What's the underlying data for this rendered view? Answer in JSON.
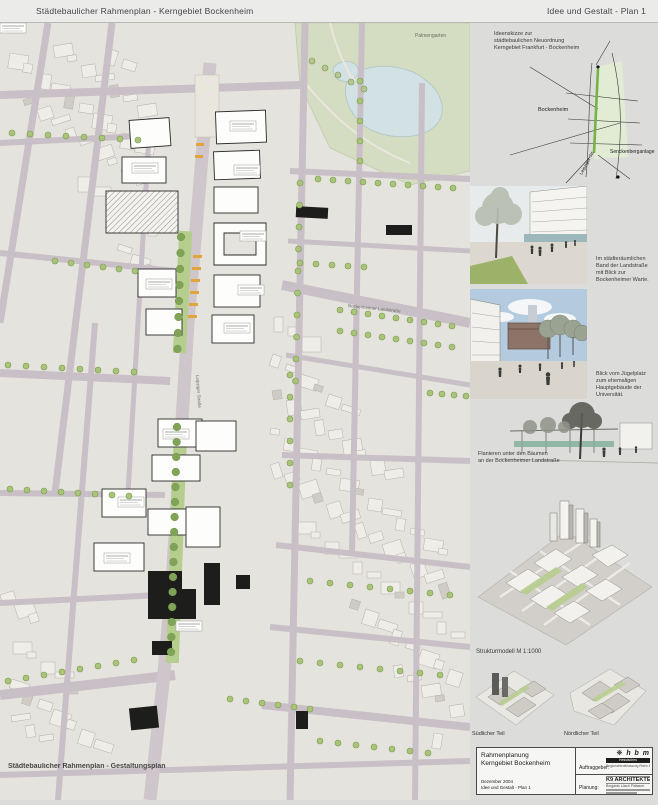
{
  "header": {
    "title_left": "Städtebaulicher Rahmenplan - Kerngebiet Bockenheim",
    "title_right": "Idee und Gestalt - Plan 1"
  },
  "map": {
    "overlay_label": "Städtebaulicher Rahmenplan - Gestaltungsplan",
    "labels": {
      "park": "Palmengarten",
      "street_main": "Leipziger Straße",
      "street_diag": "Bockenheimer Landstraße"
    }
  },
  "sidebar": {
    "sketch": {
      "caption_line1": "Ideenskizze zur",
      "caption_line2": "städtebaulichen Neuordnung",
      "caption_line3": "Kerngebiet Frankfurt - Bockenheim",
      "label_district": "Bockenheim",
      "label_senckenberg": "Senckenberganlage",
      "label_street": "Leipziger Str."
    },
    "rendering1": {
      "caption": "Im städteräumlichen Band der Landstraße mit Blick zur Bockenheimer Warte."
    },
    "rendering2": {
      "caption": "Blick vom Jügelplatz zum ehemaligen Hauptgebäude der Universität."
    },
    "rendering3": {
      "caption_line1": "Flanieren unter den Bäumen",
      "caption_line2": "an der Bockenheimer Landstraße"
    },
    "model": {
      "caption": "Strukturmodell  M 1:1000"
    },
    "parts": {
      "south": "Südlicher Teil",
      "north": "Nördlicher Teil"
    },
    "titleblock": {
      "project_line1": "Rahmenplanung",
      "project_line2": "Kerngebiet Bockenheim",
      "date": "Dezember 2004",
      "sheet": "Idee und Gestalt - Plan 1",
      "client_label": "Auftraggeber:",
      "planning_label": "Planung:",
      "client_logo_text": "h b m",
      "client_name": "Hessisches Baumanagement",
      "client_sub": "Regionalniederlassung Rhein-Main",
      "architect_name": "K9 ARCHITEKTEN",
      "architect_sub": "Borgards Lösch Piribauer"
    }
  }
}
